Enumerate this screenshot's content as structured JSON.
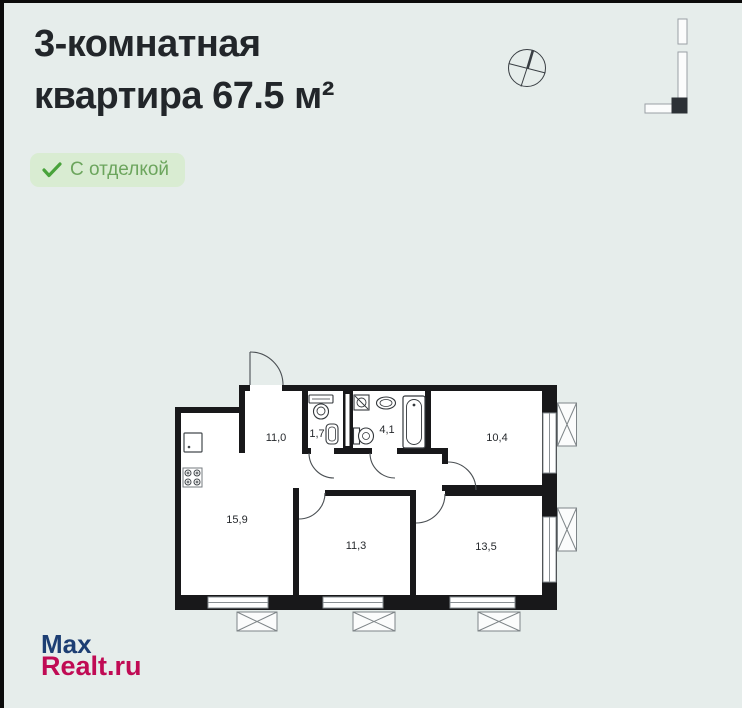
{
  "header": {
    "title_line1": "3-комнатная",
    "title_line2": "квартира 67.5 м²",
    "rooms_count": "3",
    "total_area": "67.5 м²"
  },
  "badge": {
    "label": "С отделкой",
    "check_icon": "✓",
    "bg_color": "#d9ecd2",
    "text_color": "#6ca55d",
    "check_color": "#49a33b"
  },
  "floor_plan": {
    "area_unit": "м²",
    "decimal_style": "comma",
    "rooms": [
      {
        "id": "hallway",
        "area": "11,0"
      },
      {
        "id": "wc",
        "area": "1,7"
      },
      {
        "id": "bathroom",
        "area": "4,1"
      },
      {
        "id": "bedroom-top-right",
        "area": "10,4"
      },
      {
        "id": "kitchen-living",
        "area": "15,9"
      },
      {
        "id": "bedroom-bottom-middle",
        "area": "11,3"
      },
      {
        "id": "bedroom-bottom-right",
        "area": "13,5"
      }
    ],
    "fixtures": [
      "kitchen-sink",
      "stove",
      "toilet",
      "wc-sink",
      "washing-machine",
      "bath-sink",
      "pedestal-sink",
      "bathtub"
    ],
    "symbols": {
      "window": "double-line-opening",
      "balcony_vent_box": "rect-with-X",
      "door": "quarter-arc"
    },
    "wall_color": "#18181a"
  },
  "icons": {
    "compass": "circle-with-cross-needle",
    "building_position": "L-shaped-building-outline-with-filled-unit",
    "badge_check": "✓"
  },
  "watermark": {
    "line1": "Max",
    "line2": "Realt.ru",
    "line1_color": "#1d3e73",
    "line2_color": "#c00b54"
  },
  "colors": {
    "background": "#e6edeb",
    "title_text": "#22262a",
    "plan_walls": "#18181a",
    "plan_thin_lines": "#4a4f53",
    "window_frame": "#8a9094"
  }
}
